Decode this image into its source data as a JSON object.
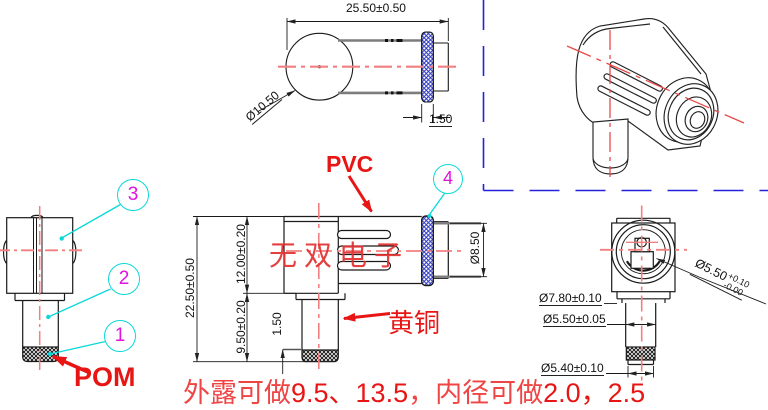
{
  "watermark": {
    "text": "无双电子",
    "color": "#e23030"
  },
  "note": {
    "part1": "外露可做",
    "part2": "9.5、13.5",
    "part3": "，内径可做",
    "part4": "2.0，2.5"
  },
  "labels": {
    "pvc": "PVC",
    "brass": "黄铜",
    "pom": "POM"
  },
  "balloons": {
    "b1": "1",
    "b2": "2",
    "b3": "3",
    "b4": "4"
  },
  "top_view": {
    "length": "25.50±0.50",
    "ball_diameter": "Ø10.50",
    "ring_width": "1.50"
  },
  "side_view": {
    "overall_height": "22.50±0.50",
    "body_height": "12.00±0.20",
    "stem_height": "9.50±0.20",
    "knurl_height": "1.50",
    "barrel_diameter": "Ø8.50"
  },
  "end_view": {
    "flange_diameter": "Ø7.80±0.10",
    "stem_diameter": "Ø5.50±0.05",
    "knurl_diameter": "Ø5.40±0.10",
    "bore": {
      "value": "Ø5.50",
      "plus": "+0.10",
      "minus": "-0.00"
    }
  },
  "colors": {
    "line": "#1a1a1a",
    "centerline": "#f28080",
    "annotation_red": "#e81515",
    "balloon_circle": "#0cd8d8",
    "balloon_number": "#e012e0",
    "knurl_blue": "#2a35c8",
    "viewport_border": "#2222dd",
    "cable_gray": "#7d7d7d"
  }
}
